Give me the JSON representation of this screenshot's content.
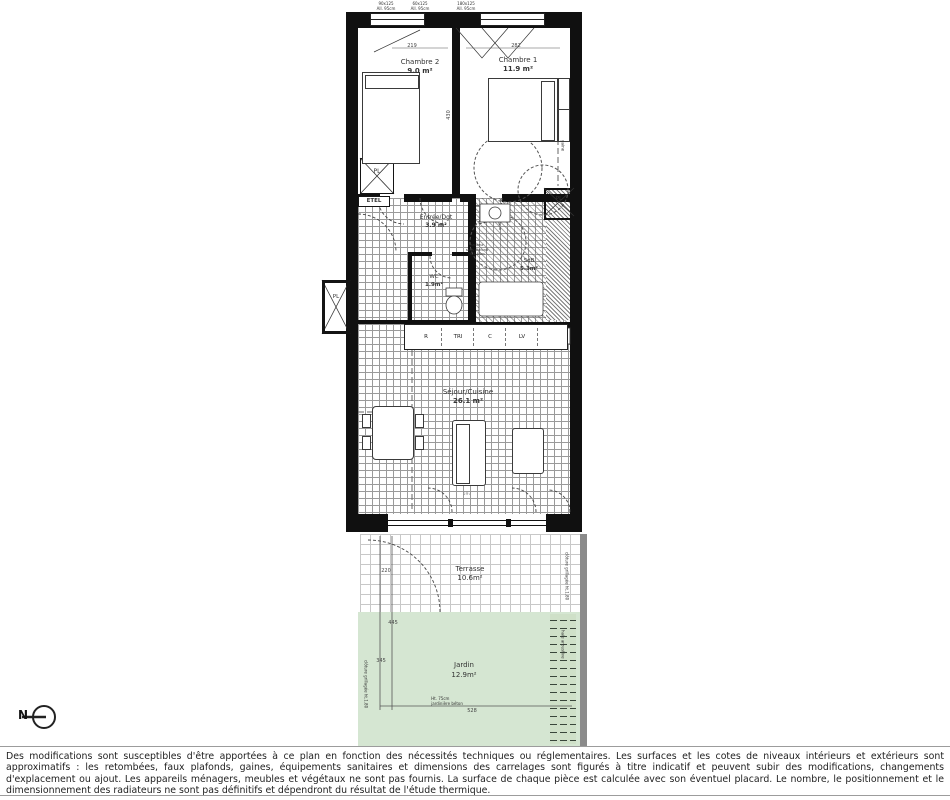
{
  "plan": {
    "rooms": {
      "chambre2": {
        "name": "Chambre 2",
        "area": "9.0 m²"
      },
      "chambre1": {
        "name": "Chambre 1",
        "area": "11.9 m²"
      },
      "entree": {
        "name": "Entrée/Dgt",
        "area": "3.9 m²"
      },
      "wc": {
        "name": "WC",
        "area": "1.9m²"
      },
      "sdb": {
        "name": "SdB",
        "area": "5.3m²"
      },
      "sejour": {
        "name": "Séjour/Cuisine",
        "area": "26.1 m²"
      },
      "terrasse": {
        "name": "Terrasse",
        "area": "10.6m²"
      },
      "jardin": {
        "name": "Jardin",
        "area": "12.9m²"
      }
    },
    "closets": {
      "pl_label": "PL",
      "etel_label": "ETEL"
    },
    "kitchen": {
      "r": "R",
      "tri": "TRI",
      "c": "C",
      "lv": "LV"
    },
    "dimensions": {
      "ch2_width": "219",
      "ch1_width": "282",
      "rooms_depth": "430",
      "terrasse_left": "220",
      "jardin_left_a": "445",
      "jardin_left_b": "345",
      "jardin_bottom_w": "528",
      "sejour_bottom_w": "597"
    },
    "annotations": {
      "window_ch2_a": "90x125\nAll. 95cm",
      "window_ch2_b": "60x125\nAll. 95cm",
      "window_ch1": "180x125\nAll. 95cm",
      "ceiling_note": "hauteur\nsous plafond\n< 1.80m",
      "gaine": "gaine",
      "terrasse_right": "clôture grillagée ht.1.80",
      "jardin_right_hedge": "haie arbustive",
      "jardin_left": "clôture grillagée ht.1.80",
      "jardin_bottom": "Ht. 75cm\njardinière béton"
    },
    "north_label": "N",
    "colors": {
      "wall": "#101010",
      "garden_green": "#d5e6d2",
      "hedge_green": "#cfe0c8"
    }
  },
  "footer": {
    "disclaimer": "Des modifications sont susceptibles d'être apportées à ce plan en fonction des nécessités techniques ou réglementaires. Les surfaces et les cotes de niveaux intérieurs et extérieurs sont approximatifs : les retombées, faux plafonds, gaines, équipements sanitaires et dimensions des carrelages sont figurés à titre indicatif et peuvent subir des modifications, changements d'explacement ou ajout. Les appareils ménagers, meubles et végétaux ne sont pas fournis. La surface de chaque pièce est calculée avec son éventuel placard. Le nombre, le positionnement et le dimensionnement des radiateurs ne sont pas définitifs et dépendront du résultat de l'étude thermique."
  }
}
